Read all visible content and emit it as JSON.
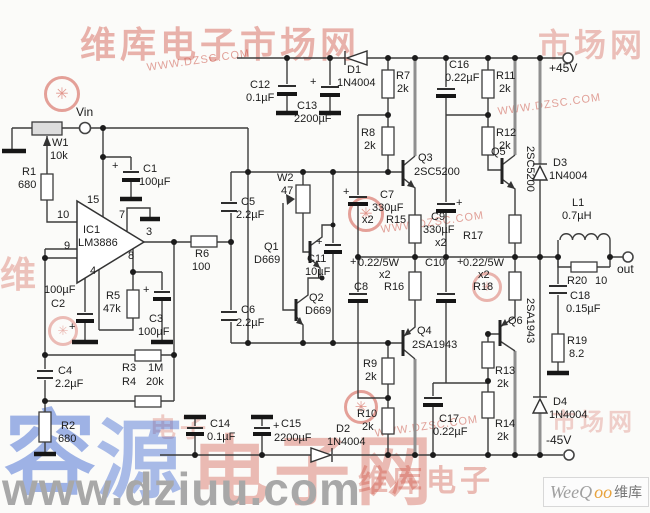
{
  "power": {
    "positive": "+45V",
    "negative": "-45V"
  },
  "io": {
    "input": "Vin",
    "output": "out"
  },
  "ic1": {
    "ref": "IC1",
    "part": "LM3886",
    "pins": {
      "p15": "15",
      "p10": "10",
      "p9": "9",
      "p7": "7",
      "p3": "3",
      "p8": "8",
      "p4": "4"
    }
  },
  "shared": {
    "x2": "x2",
    "emitter_r": "0.22/5W",
    "plus": "+"
  },
  "components": {
    "w1": {
      "ref": "W1",
      "value": "10k"
    },
    "w2": {
      "ref": "W2",
      "value": "47"
    },
    "r1": {
      "ref": "R1",
      "value": "680"
    },
    "r2": {
      "ref": "R2",
      "value": "680"
    },
    "r3": {
      "ref": "R3",
      "value": "1M"
    },
    "r4": {
      "ref": "R4",
      "value": "20k"
    },
    "r5": {
      "ref": "R5",
      "value": "47k"
    },
    "r6": {
      "ref": "R6",
      "value": "100"
    },
    "r7": {
      "ref": "R7",
      "value": "2k"
    },
    "r8": {
      "ref": "R8",
      "value": "2k"
    },
    "r9": {
      "ref": "R9",
      "value": "2k"
    },
    "r10": {
      "ref": "R10",
      "value": "2k"
    },
    "r11": {
      "ref": "R11",
      "value": "2k"
    },
    "r12": {
      "ref": "R12",
      "value": "2k"
    },
    "r13": {
      "ref": "R13",
      "value": "2k"
    },
    "r14": {
      "ref": "R14",
      "value": "2k"
    },
    "r15": {
      "ref": "R15"
    },
    "r16": {
      "ref": "R16"
    },
    "r17": {
      "ref": "R17"
    },
    "r18": {
      "ref": "R18"
    },
    "r19": {
      "ref": "R19",
      "value": "8.2"
    },
    "r20": {
      "ref": "R20",
      "value": "10"
    },
    "c1": {
      "ref": "C1",
      "value": "100µF"
    },
    "c2": {
      "ref": "C2",
      "value": "100µF"
    },
    "c3": {
      "ref": "C3",
      "value": "100µF"
    },
    "c4": {
      "ref": "C4",
      "value": "2.2µF"
    },
    "c5": {
      "ref": "C5",
      "value": "2.2µF"
    },
    "c6": {
      "ref": "C6",
      "value": "2.2µF"
    },
    "c7": {
      "ref": "C7",
      "value": "330µF"
    },
    "c8": {
      "ref": "C8"
    },
    "c9": {
      "ref": "C9",
      "value": "330µF"
    },
    "c10": {
      "ref": "C10"
    },
    "c11": {
      "ref": "C11",
      "value": "10µF"
    },
    "c12": {
      "ref": "C12",
      "value": "0.1µF"
    },
    "c13": {
      "ref": "C13",
      "value": "2200µF"
    },
    "c14": {
      "ref": "C14",
      "value": "0.1µF"
    },
    "c15": {
      "ref": "C15",
      "value": "2200µF"
    },
    "c16": {
      "ref": "C16",
      "value": "0.22µF"
    },
    "c17": {
      "ref": "C17",
      "value": "0.22µF"
    },
    "c18": {
      "ref": "C18",
      "value": "0.15µF"
    },
    "d1": {
      "ref": "D1",
      "value": "1N4004"
    },
    "d2": {
      "ref": "D2",
      "value": "1N4004"
    },
    "d3": {
      "ref": "D3",
      "value": "1N4004"
    },
    "d4": {
      "ref": "D4",
      "value": "1N4004"
    },
    "q1": {
      "ref": "Q1",
      "value": "D669"
    },
    "q2": {
      "ref": "Q2",
      "value": "D669"
    },
    "q3": {
      "ref": "Q3",
      "value": "2SC5200"
    },
    "q4": {
      "ref": "Q4",
      "value": "2SA1943"
    },
    "q5": {
      "ref": "Q5",
      "value": "2SC5200"
    },
    "q6": {
      "ref": "Q6",
      "value": "2SA1943"
    },
    "l1": {
      "ref": "L1",
      "value": "0.7µH"
    }
  },
  "watermarks": {
    "brand_cn": "维库电子市场网",
    "brand_cn_short": "维库电子",
    "brand_cn_tail": "市场网",
    "brand_char": "维",
    "brand_char2": "电子",
    "brand_url": "WWW.DZSC.COM",
    "logo_glyph": "✳",
    "bottom_url": "www.dziuu.com",
    "rong": "容",
    "yuan": "源",
    "dzw": "电子网",
    "weeqoo_a": "WeeQ",
    "weeqoo_b": "oo",
    "weeqoo_c": "维库"
  }
}
